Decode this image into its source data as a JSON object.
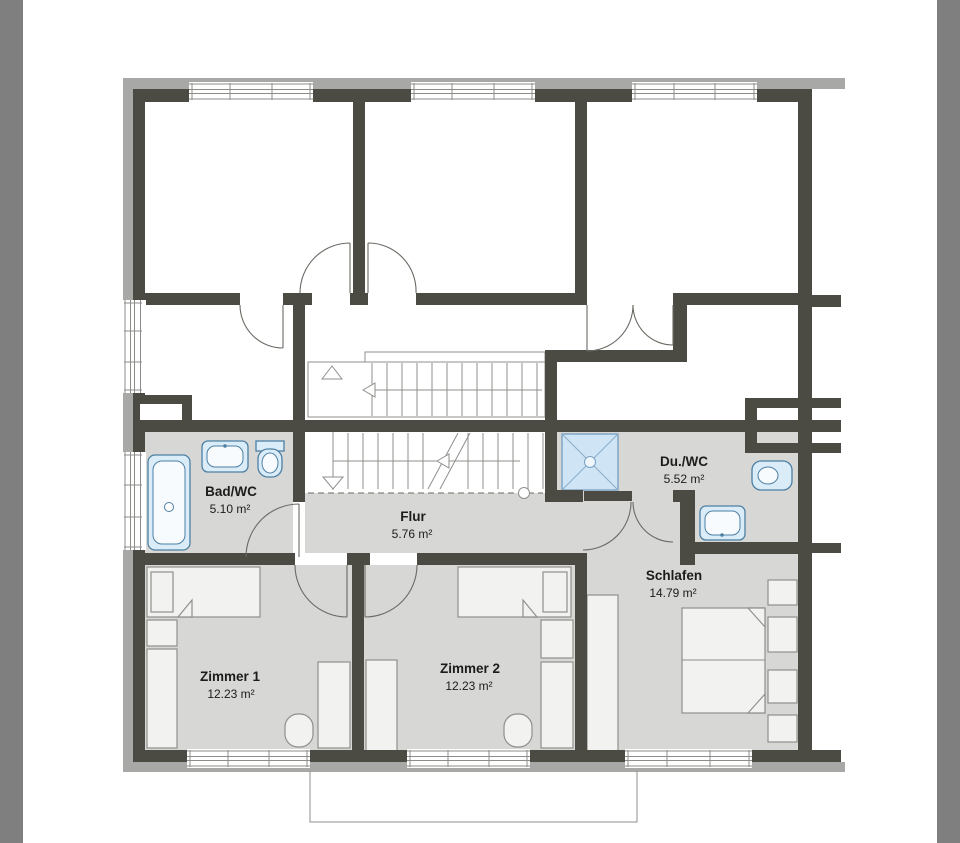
{
  "rooms": {
    "bad_wc": {
      "name": "Bad/WC",
      "area": "5.10 m²"
    },
    "flur": {
      "name": "Flur",
      "area": "5.76 m²"
    },
    "du_wc": {
      "name": "Du./WC",
      "area": "5.52 m²"
    },
    "schlafen": {
      "name": "Schlafen",
      "area": "14.79 m²"
    },
    "zimmer1": {
      "name": "Zimmer 1",
      "area": "12.23 m²"
    },
    "zimmer2": {
      "name": "Zimmer 2",
      "area": "12.23 m²"
    }
  },
  "colors": {
    "wall": "#4b4b44",
    "insulation": "#a8a8a6",
    "floor": "#d7d7d5",
    "fixture_fill": "#d9ecf8",
    "fixture_stroke": "#4d7fa3",
    "shower_fill": "#cfe4f5",
    "furniture_fill": "#f2f2f0",
    "furniture_stroke": "#8f8f8b",
    "gutter": "#7f7f7f",
    "text": "#1c1c1c"
  }
}
